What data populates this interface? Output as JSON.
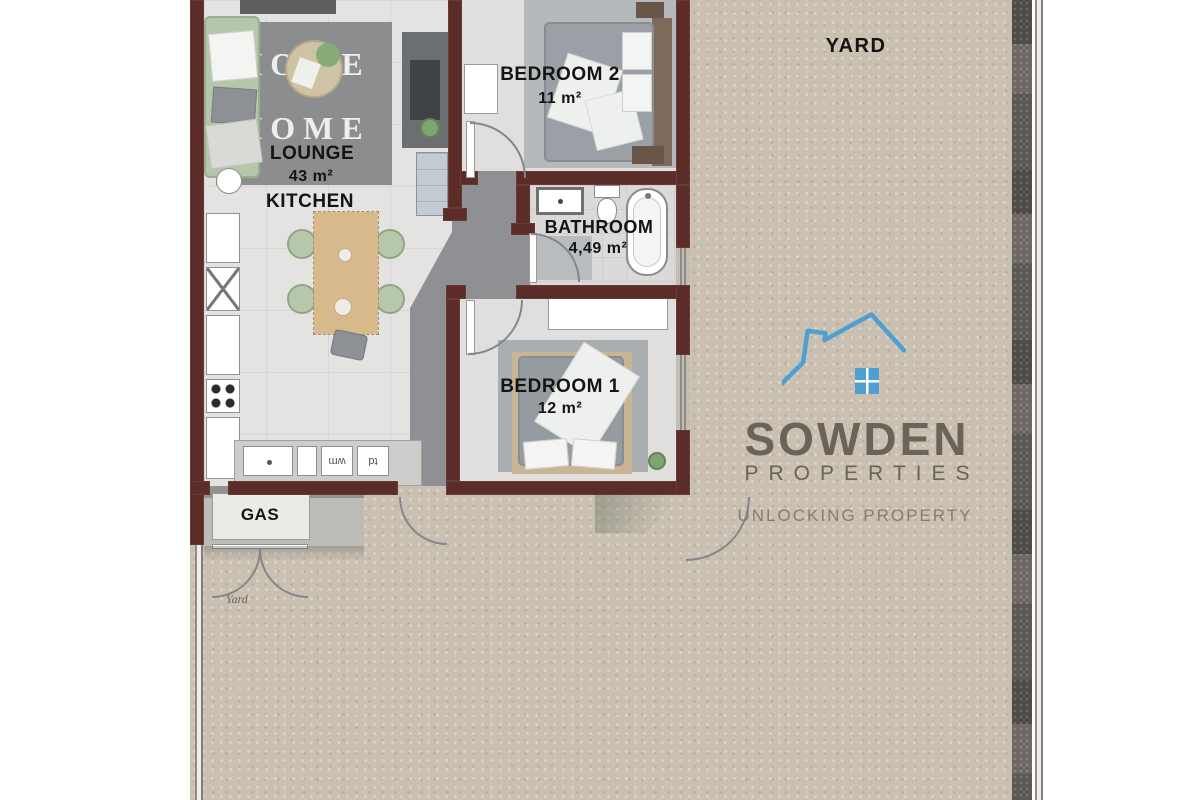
{
  "plan": {
    "yard_label": "YARD",
    "yard_small_label": "Yard",
    "rooms": {
      "lounge": {
        "name": "LOUNGE",
        "area": "43 m²"
      },
      "kitchen": {
        "name": "KITCHEN"
      },
      "bedroom2": {
        "name": "BEDROOM 2",
        "area": "11 m²"
      },
      "bathroom": {
        "name": "BATHROOM",
        "area": "4,49 m²"
      },
      "bedroom1": {
        "name": "BEDROOM 1",
        "area": "12 m²"
      },
      "gas": {
        "name": "GAS"
      }
    },
    "rug": {
      "line1": "HOME",
      "line2": "HOME"
    },
    "appliances": {
      "washing_machine": "wm",
      "tumble_dryer": "td"
    },
    "colors": {
      "wall": "#5c2c29",
      "yard": "#c9c0b2",
      "floor": "#e4e3e1",
      "hall": "#8f9094",
      "boundary_wall": "#6e6a63"
    }
  },
  "branding": {
    "name": "SOWDEN",
    "subtitle": "PROPERTIES",
    "tagline": "UNLOCKING PROPERTY",
    "logo_house_color": "#4f9fd0",
    "logo_text_color": "#6b625a"
  }
}
